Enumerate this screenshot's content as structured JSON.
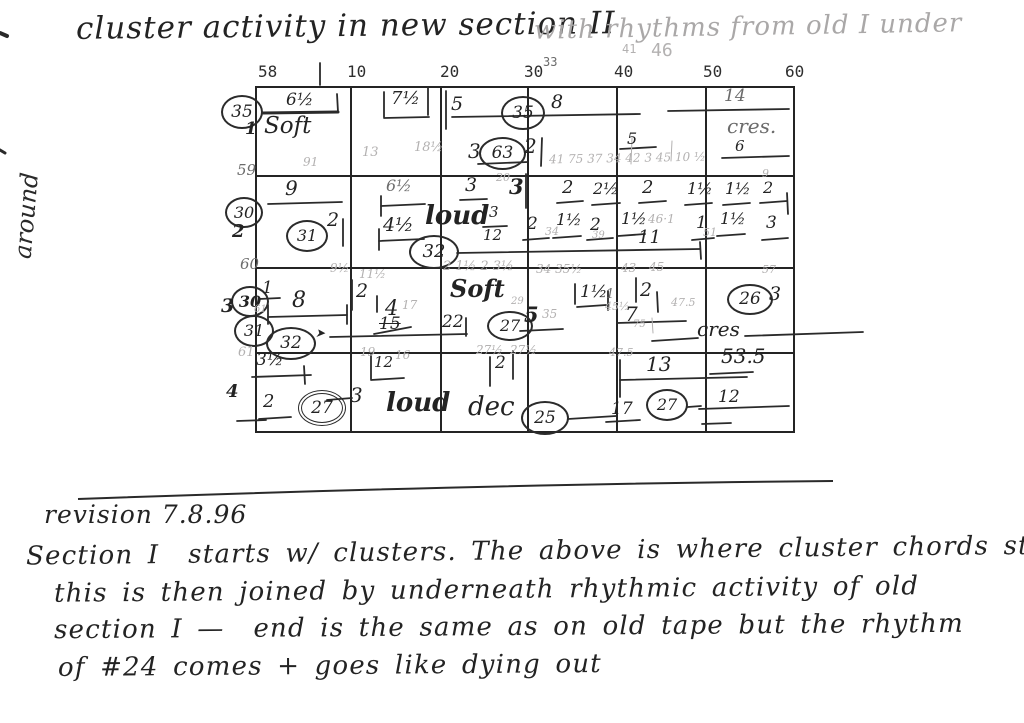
{
  "title": {
    "main": "cluster activity in new section II",
    "annotation": "with rhythms from old I under"
  },
  "margin_note": "around",
  "grid": {
    "column_headers": [
      {
        "t": "58",
        "x": 258,
        "y": 64,
        "fs": 16
      },
      {
        "t": "10",
        "x": 347,
        "y": 64,
        "fs": 16
      },
      {
        "t": "20",
        "x": 440,
        "y": 64,
        "fs": 16
      },
      {
        "t": "30",
        "x": 524,
        "y": 64,
        "fs": 16
      },
      {
        "t": "33",
        "x": 543,
        "y": 56,
        "fs": 12,
        "cls": "light"
      },
      {
        "t": "40",
        "x": 614,
        "y": 64,
        "fs": 16
      },
      {
        "t": "41",
        "x": 622,
        "y": 43,
        "fs": 12,
        "cls": "pencil"
      },
      {
        "t": "46",
        "x": 651,
        "y": 42,
        "fs": 18,
        "cls": "pencil"
      },
      {
        "t": "50",
        "x": 703,
        "y": 64,
        "fs": 16
      },
      {
        "t": "60",
        "x": 785,
        "y": 64,
        "fs": 16
      }
    ],
    "annotations": [
      {
        "t": "35",
        "x": 221,
        "y": 95,
        "w": 42,
        "h": 34,
        "fs": 17
      },
      {
        "t": "1",
        "x": 245,
        "y": 121,
        "fs": 17,
        "cls": "bold"
      },
      {
        "t": "59",
        "x": 237,
        "y": 163,
        "fs": 15,
        "cls": "light"
      },
      {
        "t": "30",
        "x": 225,
        "y": 197,
        "w": 38,
        "h": 31,
        "fs": 16
      },
      {
        "t": "2",
        "x": 232,
        "y": 223,
        "fs": 18,
        "cls": "bold"
      },
      {
        "t": "60",
        "x": 240,
        "y": 257,
        "fs": 15,
        "cls": "light"
      },
      {
        "t": "30",
        "x": 231,
        "y": 286,
        "w": 38,
        "h": 31,
        "fs": 16,
        "cls": "bold"
      },
      {
        "t": "3",
        "x": 221,
        "y": 297,
        "fs": 19,
        "cls": "bold"
      },
      {
        "t": "31",
        "x": 234,
        "y": 315,
        "w": 40,
        "h": 32,
        "fs": 16
      },
      {
        "t": "32",
        "x": 266,
        "y": 327,
        "w": 50,
        "h": 33,
        "fs": 17
      },
      {
        "t": "61",
        "x": 238,
        "y": 346,
        "fs": 13,
        "cls": "pencil"
      },
      {
        "t": "4",
        "x": 226,
        "y": 383,
        "fs": 18,
        "cls": "bold"
      },
      {
        "t": "6½",
        "x": 286,
        "y": 92,
        "fs": 17
      },
      {
        "t": "Soft",
        "x": 264,
        "y": 115,
        "fs": 23,
        "n": "dynamics-label"
      },
      {
        "t": "7½",
        "x": 391,
        "y": 90,
        "fs": 18
      },
      {
        "t": "5",
        "x": 451,
        "y": 95,
        "fs": 19
      },
      {
        "t": "35",
        "x": 501,
        "y": 96,
        "w": 44,
        "h": 34,
        "fs": 17
      },
      {
        "t": "8",
        "x": 551,
        "y": 93,
        "fs": 19
      },
      {
        "t": "14",
        "x": 724,
        "y": 88,
        "fs": 17,
        "cls": "light"
      },
      {
        "t": "cres.",
        "x": 727,
        "y": 116,
        "fs": 20,
        "cls": "light",
        "n": "dynamics-label"
      },
      {
        "t": "5",
        "x": 627,
        "y": 131,
        "fs": 16
      },
      {
        "t": "6",
        "x": 735,
        "y": 139,
        "fs": 15
      },
      {
        "t": "91",
        "x": 303,
        "y": 156,
        "fs": 12,
        "cls": "pencil"
      },
      {
        "t": "13",
        "x": 362,
        "y": 146,
        "fs": 13,
        "cls": "pencil"
      },
      {
        "t": "18½",
        "x": 414,
        "y": 141,
        "fs": 13,
        "cls": "pencil"
      },
      {
        "t": "3",
        "x": 468,
        "y": 141,
        "fs": 20
      },
      {
        "t": "63",
        "x": 479,
        "y": 137,
        "w": 47,
        "h": 33,
        "fs": 17
      },
      {
        "t": "2",
        "x": 524,
        "y": 136,
        "fs": 20
      },
      {
        "t": "41 75 37 34 42 3 45 10 ½",
        "x": 549,
        "y": 152,
        "fs": 12,
        "cls": "pencil",
        "rot": -1
      },
      {
        "t": "9",
        "x": 285,
        "y": 178,
        "fs": 20
      },
      {
        "t": "6½",
        "x": 386,
        "y": 178,
        "fs": 16,
        "cls": "light"
      },
      {
        "t": "3",
        "x": 465,
        "y": 176,
        "fs": 19
      },
      {
        "t": "20",
        "x": 496,
        "y": 172,
        "fs": 11,
        "cls": "pencil"
      },
      {
        "t": "3",
        "x": 509,
        "y": 176,
        "fs": 21,
        "cls": "bold"
      },
      {
        "t": "2",
        "x": 562,
        "y": 179,
        "fs": 18
      },
      {
        "t": "2½",
        "x": 593,
        "y": 181,
        "fs": 16
      },
      {
        "t": "2",
        "x": 642,
        "y": 179,
        "fs": 18
      },
      {
        "t": "1½",
        "x": 687,
        "y": 181,
        "fs": 16
      },
      {
        "t": "1½",
        "x": 725,
        "y": 181,
        "fs": 16
      },
      {
        "t": "9",
        "x": 762,
        "y": 168,
        "fs": 11,
        "cls": "pencil"
      },
      {
        "t": "2",
        "x": 763,
        "y": 180,
        "fs": 16
      },
      {
        "t": "31",
        "x": 286,
        "y": 220,
        "w": 42,
        "h": 32,
        "fs": 16
      },
      {
        "t": "2",
        "x": 327,
        "y": 211,
        "fs": 19
      },
      {
        "t": "4½",
        "x": 383,
        "y": 216,
        "fs": 19
      },
      {
        "t": "loud",
        "x": 425,
        "y": 203,
        "fs": 26,
        "cls": "bold",
        "n": "dynamics-label"
      },
      {
        "t": "3",
        "x": 489,
        "y": 205,
        "fs": 15
      },
      {
        "t": "12",
        "x": 483,
        "y": 228,
        "fs": 15
      },
      {
        "t": "2",
        "x": 527,
        "y": 216,
        "fs": 17
      },
      {
        "t": "34",
        "x": 545,
        "y": 226,
        "fs": 11,
        "cls": "pencil"
      },
      {
        "t": "1½",
        "x": 556,
        "y": 212,
        "fs": 16
      },
      {
        "t": "2",
        "x": 590,
        "y": 217,
        "fs": 17
      },
      {
        "t": "39",
        "x": 592,
        "y": 231,
        "fs": 10,
        "cls": "pencil"
      },
      {
        "t": "1½",
        "x": 621,
        "y": 211,
        "fs": 16
      },
      {
        "t": "46·1",
        "x": 648,
        "y": 213,
        "fs": 12,
        "cls": "pencil"
      },
      {
        "t": "1",
        "x": 696,
        "y": 215,
        "fs": 17
      },
      {
        "t": "1½",
        "x": 720,
        "y": 211,
        "fs": 16
      },
      {
        "t": "3",
        "x": 766,
        "y": 215,
        "fs": 17
      },
      {
        "t": "11",
        "x": 638,
        "y": 229,
        "fs": 18
      },
      {
        "t": "51",
        "x": 703,
        "y": 227,
        "fs": 11,
        "cls": "pencil"
      },
      {
        "t": "32",
        "x": 409,
        "y": 235,
        "w": 50,
        "h": 34,
        "fs": 18
      },
      {
        "t": "9½",
        "x": 330,
        "y": 262,
        "fs": 12,
        "cls": "pencil"
      },
      {
        "t": "11½",
        "x": 359,
        "y": 268,
        "fs": 12,
        "cls": "pencil"
      },
      {
        "t": "1",
        "x": 262,
        "y": 280,
        "fs": 17
      },
      {
        "t": "8",
        "x": 292,
        "y": 290,
        "fs": 22
      },
      {
        "t": "61",
        "x": 254,
        "y": 305,
        "fs": 10,
        "cls": "pencil"
      },
      {
        "t": "2",
        "x": 356,
        "y": 282,
        "fs": 19
      },
      {
        "t": "4",
        "x": 385,
        "y": 298,
        "fs": 21
      },
      {
        "t": "17",
        "x": 402,
        "y": 299,
        "fs": 12,
        "cls": "pencil"
      },
      {
        "t": "15",
        "x": 379,
        "y": 316,
        "fs": 17,
        "cls": "strike"
      },
      {
        "t": "➤",
        "x": 315,
        "y": 327,
        "fs": 12,
        "n": "arrow-mark"
      },
      {
        "t": "22",
        "x": 442,
        "y": 314,
        "fs": 17
      },
      {
        "t": "Soft",
        "x": 450,
        "y": 277,
        "fs": 24,
        "cls": "bold",
        "n": "dynamics-label"
      },
      {
        "t": "2 1½ 2 3½",
        "x": 443,
        "y": 260,
        "fs": 13,
        "cls": "pencil"
      },
      {
        "t": "34 35½",
        "x": 536,
        "y": 263,
        "fs": 12,
        "cls": "pencil"
      },
      {
        "t": "1½",
        "x": 580,
        "y": 284,
        "fs": 17
      },
      {
        "t": "1",
        "x": 606,
        "y": 288,
        "fs": 13,
        "cls": "light"
      },
      {
        "t": "29",
        "x": 511,
        "y": 297,
        "fs": 10,
        "cls": "pencil"
      },
      {
        "t": "27",
        "x": 487,
        "y": 311,
        "w": 46,
        "h": 30,
        "fs": 16
      },
      {
        "t": "5",
        "x": 524,
        "y": 304,
        "fs": 21,
        "cls": "bold"
      },
      {
        "t": "35",
        "x": 542,
        "y": 308,
        "fs": 12,
        "cls": "pencil"
      },
      {
        "t": "43",
        "x": 621,
        "y": 262,
        "fs": 12,
        "cls": "pencil"
      },
      {
        "t": "45",
        "x": 649,
        "y": 261,
        "fs": 12,
        "cls": "pencil"
      },
      {
        "t": "2",
        "x": 640,
        "y": 281,
        "fs": 19
      },
      {
        "t": "45½",
        "x": 605,
        "y": 301,
        "fs": 11,
        "cls": "pencil"
      },
      {
        "t": "7",
        "x": 625,
        "y": 304,
        "fs": 20
      },
      {
        "t": "47.5",
        "x": 671,
        "y": 297,
        "fs": 11,
        "cls": "pencil"
      },
      {
        "t": "75",
        "x": 633,
        "y": 320,
        "fs": 10,
        "cls": "pencil"
      },
      {
        "t": "cres",
        "x": 697,
        "y": 319,
        "fs": 20,
        "n": "dynamics-label"
      },
      {
        "t": "26",
        "x": 727,
        "y": 284,
        "w": 46,
        "h": 31,
        "fs": 17
      },
      {
        "t": "3",
        "x": 769,
        "y": 285,
        "fs": 19
      },
      {
        "t": "57",
        "x": 762,
        "y": 264,
        "fs": 11,
        "cls": "pencil"
      },
      {
        "t": "3½",
        "x": 256,
        "y": 352,
        "fs": 17
      },
      {
        "t": "19",
        "x": 360,
        "y": 346,
        "fs": 12,
        "cls": "pencil"
      },
      {
        "t": "12",
        "x": 374,
        "y": 355,
        "fs": 15
      },
      {
        "t": "16",
        "x": 395,
        "y": 349,
        "fs": 12,
        "cls": "pencil"
      },
      {
        "t": "27½",
        "x": 476,
        "y": 344,
        "fs": 12,
        "cls": "pencil"
      },
      {
        "t": "27½",
        "x": 510,
        "y": 344,
        "fs": 12,
        "cls": "pencil"
      },
      {
        "t": "2",
        "x": 495,
        "y": 355,
        "fs": 17
      },
      {
        "t": "2",
        "x": 263,
        "y": 393,
        "fs": 18
      },
      {
        "t": "27",
        "x": 298,
        "y": 390,
        "w": 48,
        "h": 36,
        "fs": 17,
        "cls": "double"
      },
      {
        "t": "3",
        "x": 350,
        "y": 385,
        "fs": 20
      },
      {
        "t": "loud",
        "x": 386,
        "y": 390,
        "fs": 26,
        "cls": "bold",
        "n": "dynamics-label"
      },
      {
        "t": "dec",
        "x": 468,
        "y": 394,
        "fs": 26,
        "n": "dynamics-label"
      },
      {
        "t": "25",
        "x": 521,
        "y": 401,
        "w": 48,
        "h": 34,
        "fs": 17
      },
      {
        "t": "17",
        "x": 611,
        "y": 401,
        "fs": 17
      },
      {
        "t": "47.5",
        "x": 609,
        "y": 347,
        "fs": 11,
        "cls": "pencil"
      },
      {
        "t": "13",
        "x": 646,
        "y": 354,
        "fs": 20
      },
      {
        "t": "53.5",
        "x": 721,
        "y": 346,
        "fs": 20
      },
      {
        "t": "27",
        "x": 646,
        "y": 389,
        "w": 42,
        "h": 32,
        "fs": 16
      },
      {
        "t": "12",
        "x": 718,
        "y": 389,
        "fs": 17
      }
    ]
  },
  "notes": {
    "revision": "revision 7.8.96",
    "lines": [
      "Section I  starts w/ clusters. The above is where cluster chords start",
      "this is then joined by underneath rhythmic activity of old",
      "section I —  end is the same as on old tape but the rhythm",
      "of #24 comes + goes like dying out"
    ]
  }
}
